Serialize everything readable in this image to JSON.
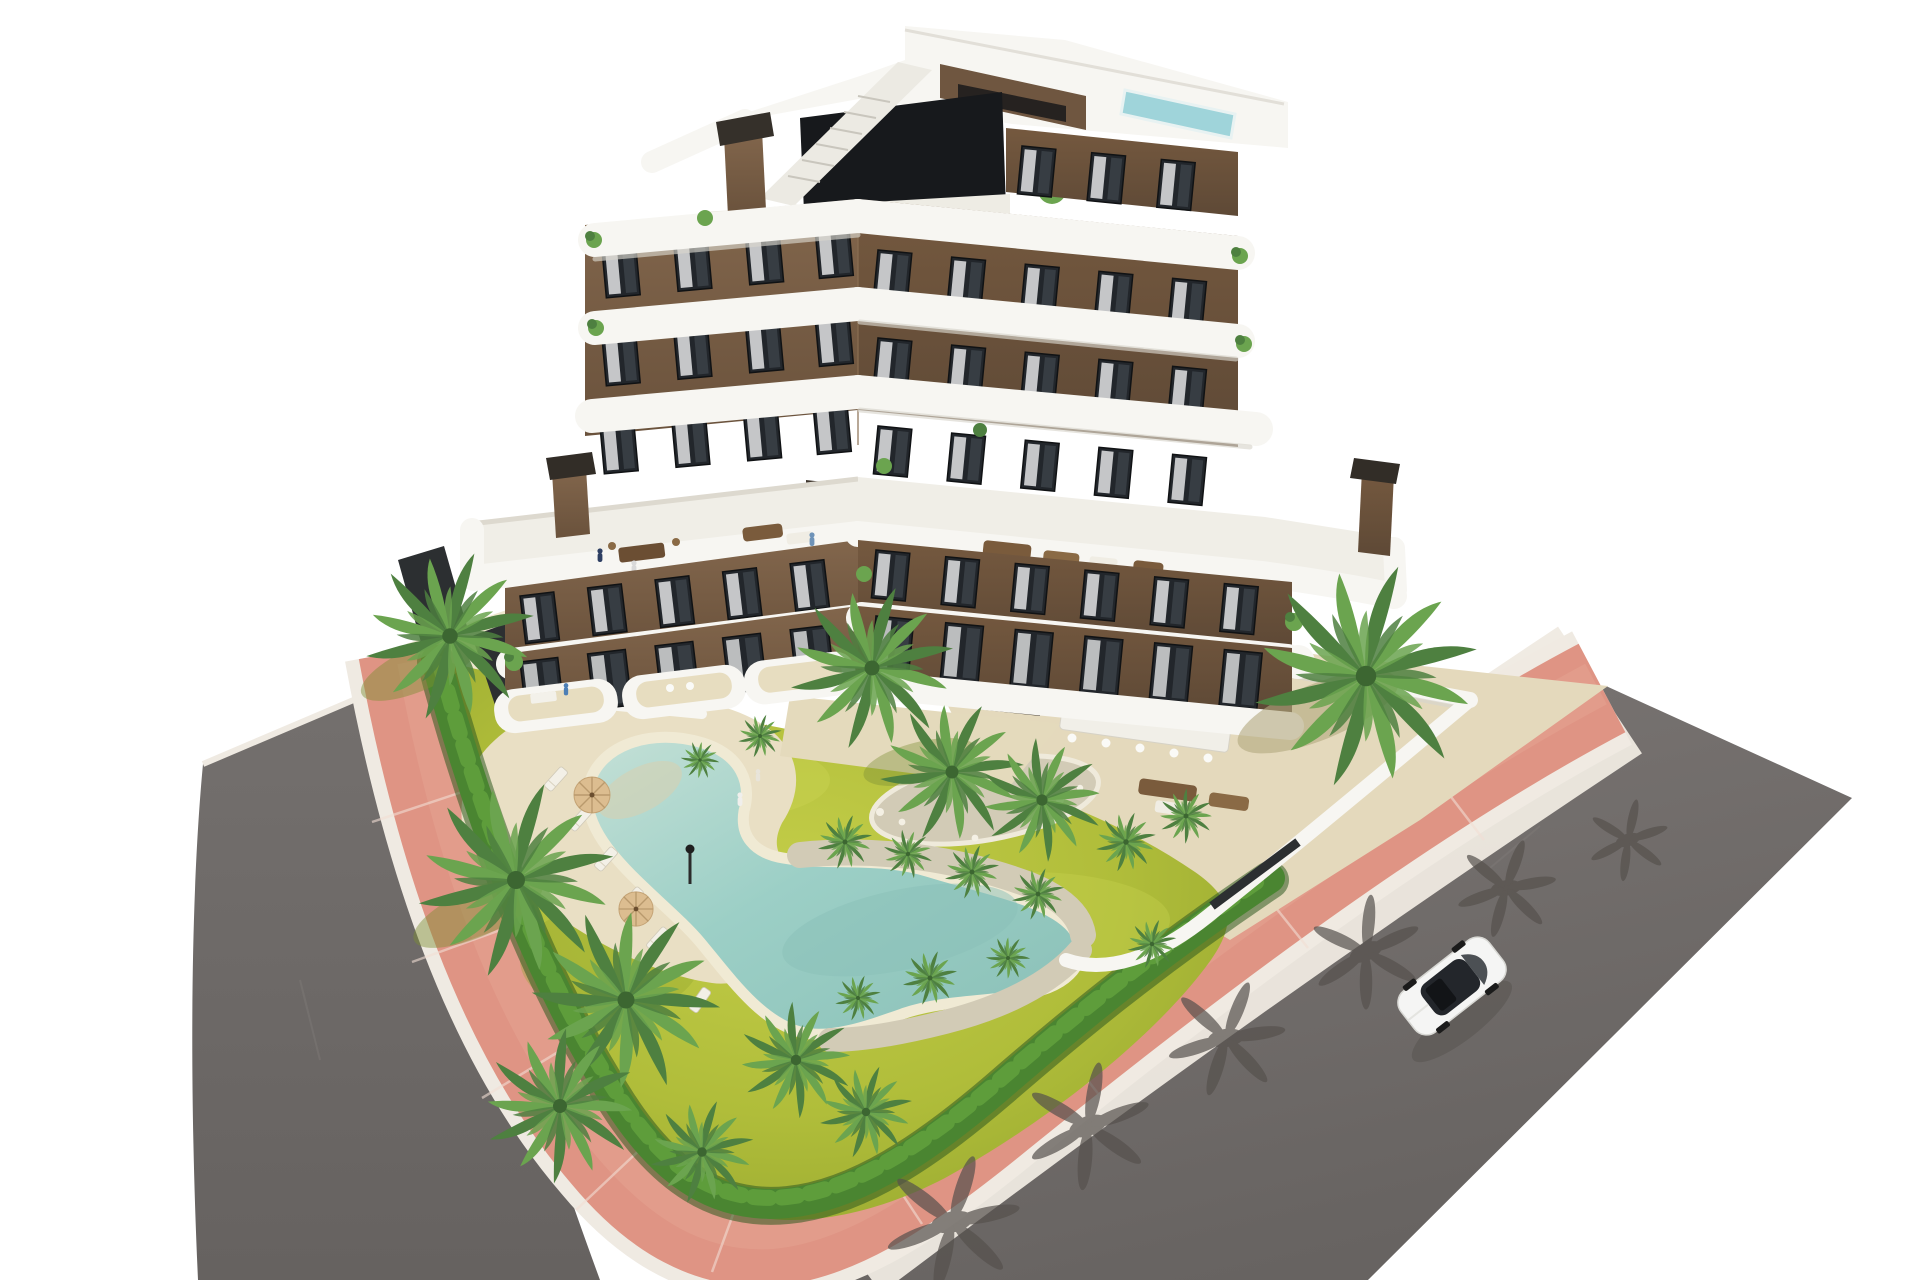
{
  "meta": {
    "title": "Aerial architectural render — modern apartment residence with garden pool",
    "description": "Photorealistic aerial 3D rendering of a modern 7-storey apartment building with brown facades and curved white balcony bands, rooftop terraces with furniture and a small rooftop pool, a landscaped garden with palm trees and hedges, a free-form sandy-edged swimming pool with sun loungers and parasols, a pink perimeter sidewalk and grey asphalt streets with one white car driving by."
  },
  "scene": {
    "building": {
      "storeys_tower": 7,
      "storeys_wings": 5,
      "facade_color": "#6f5640",
      "balcony_band_color": "#f7f6f2",
      "window_color": "#22262b",
      "features": [
        "rooftop-pool",
        "roof-terraces",
        "curved-white-balconies",
        "two-chimneys-per-wing",
        "external-roof-stair",
        "courtyard-palm",
        "ground-floor-terraces"
      ]
    },
    "garden": {
      "grass_color": "#b0bd3a",
      "hedge_color": "#4a8531",
      "palm_trees": 14,
      "features": [
        "perimeter-hedge",
        "gravel-planting-islands",
        "sand-paths",
        "shrubs"
      ]
    },
    "pool": {
      "water_color": "#9ccfc6",
      "rim_color": "#f0ead4",
      "deck_color": "#e9dfc4",
      "loungers": 5,
      "umbrellas": 2,
      "umbrella_color": "#dcbd90",
      "lamp_posts": 1
    },
    "streets": {
      "asphalt_color": "#6f6b69",
      "sidewalk_color": "#df9484",
      "curb_color": "#efeae2",
      "tree_shadows": 6,
      "car": {
        "count": 1,
        "body_color": "#f5f5f4",
        "type": "white-sedan",
        "heading": "south-west"
      }
    },
    "people_visible": 10
  },
  "palette": {
    "bg": "#ffffff",
    "asphalt": "#6f6b69",
    "asphaltDark": "#635f5d",
    "roadShadow": "#56514d",
    "pink": "#df9484",
    "pinkLight": "#e9ab99",
    "curb": "#efeae2",
    "sand": "#e4d9bc",
    "sandLight": "#efe7cf",
    "gravel": "#d2cbb6",
    "grass": "#b0bd3a",
    "grassLight": "#c9d351",
    "grassDark": "#93a52e",
    "hedge": "#4a8531",
    "hedgeDark": "#2f5a20",
    "palm": "#4e8040",
    "palmLight": "#6ba44f",
    "facadeLight": "#7c6148",
    "facade": "#6f5640",
    "facadeDark": "#53402f",
    "bandWhite": "#f7f6f2",
    "bandShadow": "#d8d5cd",
    "glass": "#22262b",
    "glassLight": "#3a4046",
    "curtain": "#e2e3e4",
    "water": "#9ccfc6",
    "waterDeep": "#8ac0b7",
    "poolRim": "#f0ead4",
    "roofPool": "#9fd4da",
    "carWhite": "#f5f5f4",
    "darkFence": "#2c2f31",
    "furniture": "#7a5b3c",
    "cushion": "#f0ede4",
    "notch": "#3f362e",
    "trunk": "#9a8a6c"
  }
}
